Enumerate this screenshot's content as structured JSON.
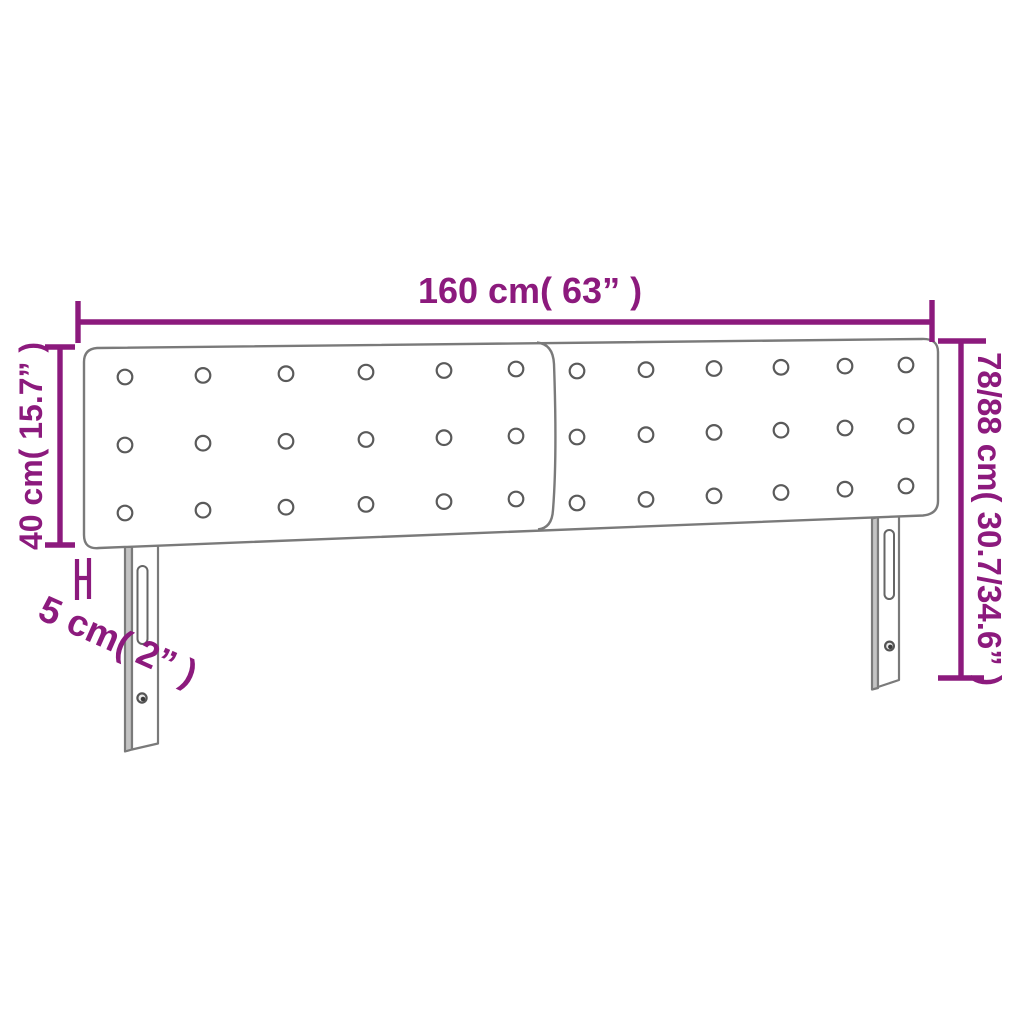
{
  "diagram": {
    "type": "product-dimension-diagram",
    "product": "headboard-with-two-tufted-panels-and-two-legs",
    "labels": {
      "width": "160 cm( 63” )",
      "total_height": "78/88 cm( 30.7/34.6” )",
      "panel_height": "40 cm( 15.7” )",
      "depth": "5 cm( 2” )"
    },
    "colors": {
      "dimension_accent": "#8C1A7D",
      "outline_gray": "#7A7A7A",
      "background": "#FFFFFF"
    }
  }
}
